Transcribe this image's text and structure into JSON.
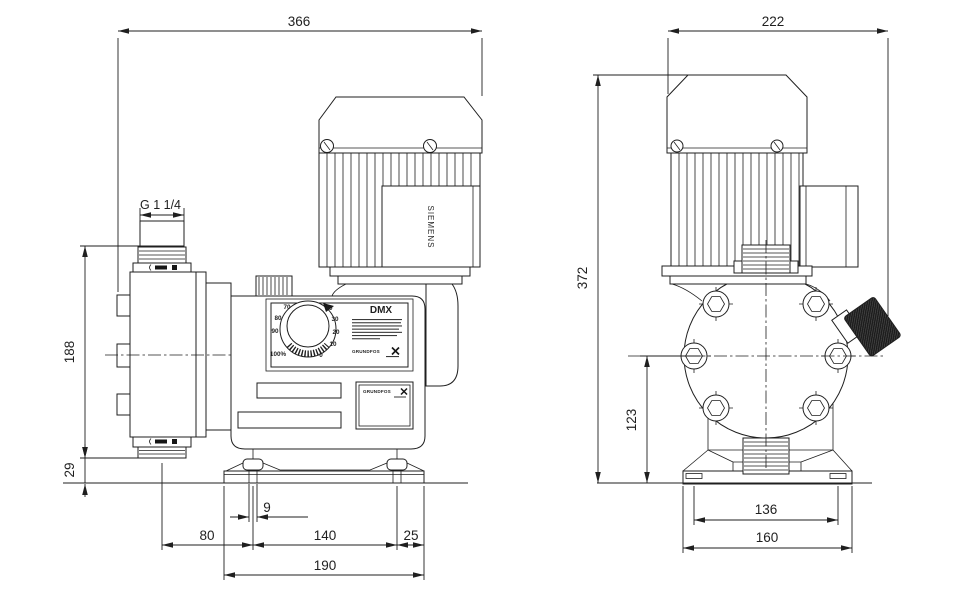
{
  "page": {
    "background": "#ffffff",
    "line_color": "#1f1f1f"
  },
  "drawing": {
    "type": "technical-dimension-drawing",
    "subject": "DMX dosing pump outline drawing",
    "views": [
      {
        "id": "side",
        "name": "side view"
      },
      {
        "id": "front",
        "name": "front view"
      }
    ]
  },
  "dimensions": {
    "side": {
      "overall_width": "366",
      "connection_thread": "G 1 1/4",
      "head_span": "188",
      "bottom_clearance": "29",
      "slot_width": "9",
      "foot_offset_left": "80",
      "foot_spacing": "140",
      "foot_offset_right": "25",
      "base_width": "190"
    },
    "front": {
      "overall_width": "222",
      "overall_height": "372",
      "head_center_height": "123",
      "foot_spacing": "136",
      "base_width": "160"
    }
  },
  "labels": {
    "model": "DMX",
    "motor_brand": "SIEMENS",
    "brand_logo": "GRUNDFOS"
  },
  "dial": {
    "values": [
      "0",
      "10",
      "20",
      "30",
      "40",
      "70",
      "80",
      "90",
      "100%"
    ]
  }
}
